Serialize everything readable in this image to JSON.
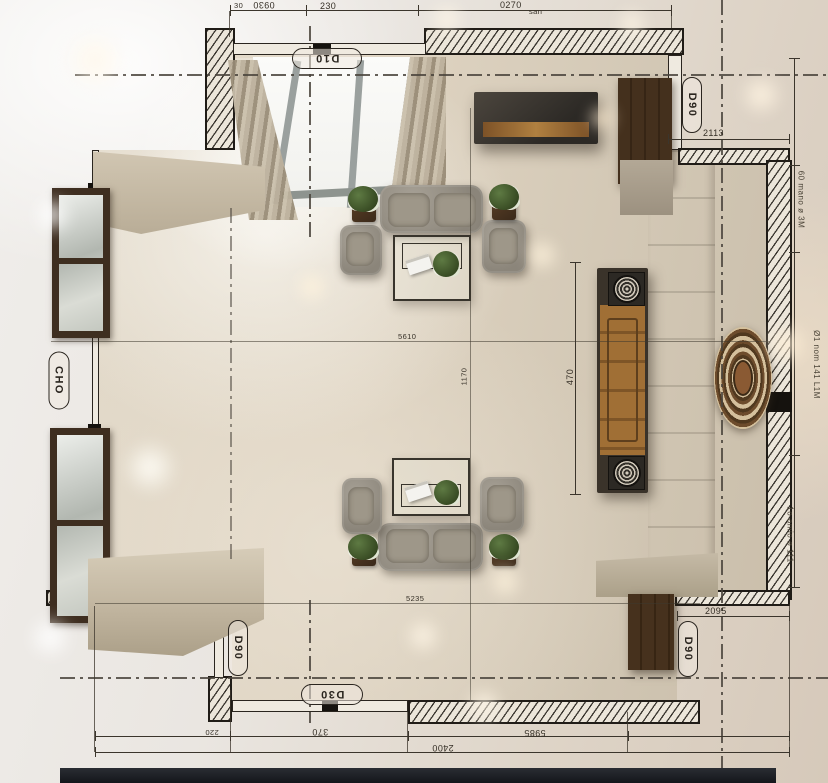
{
  "meta": {
    "description": "Top-down 3D render of a living room floor plan with CAD dimension overlay"
  },
  "tags": {
    "d10": "D10",
    "d90_top": "D90",
    "cho": "CHO",
    "d90_bottom_left": "D90",
    "d30_bottom": "D30",
    "d90_bottom_right": "D90"
  },
  "dims": {
    "n30": "30",
    "n0930": "0930",
    "n230": "230",
    "n0270": "0270",
    "san": "san",
    "n2113": "2113",
    "n470": "470",
    "n1170": "1170",
    "n5610": "5610",
    "n5235": "5235",
    "n2095": "2095",
    "n220": "220",
    "n370": "370",
    "n5985": "5985",
    "n2400": "2400"
  },
  "notes": {
    "right_top": "60 mano ø 3M",
    "right_mid": "Ø1 nom 141 L1M",
    "right_bottom": "1o amio ø 111"
  },
  "colors": {
    "floor": "#d8cec0",
    "wall_ink": "#201c17",
    "wood": "#9a6a33",
    "sofa": "#948e83",
    "rug": "#6b4a2c",
    "speaker": "#2c2924"
  }
}
